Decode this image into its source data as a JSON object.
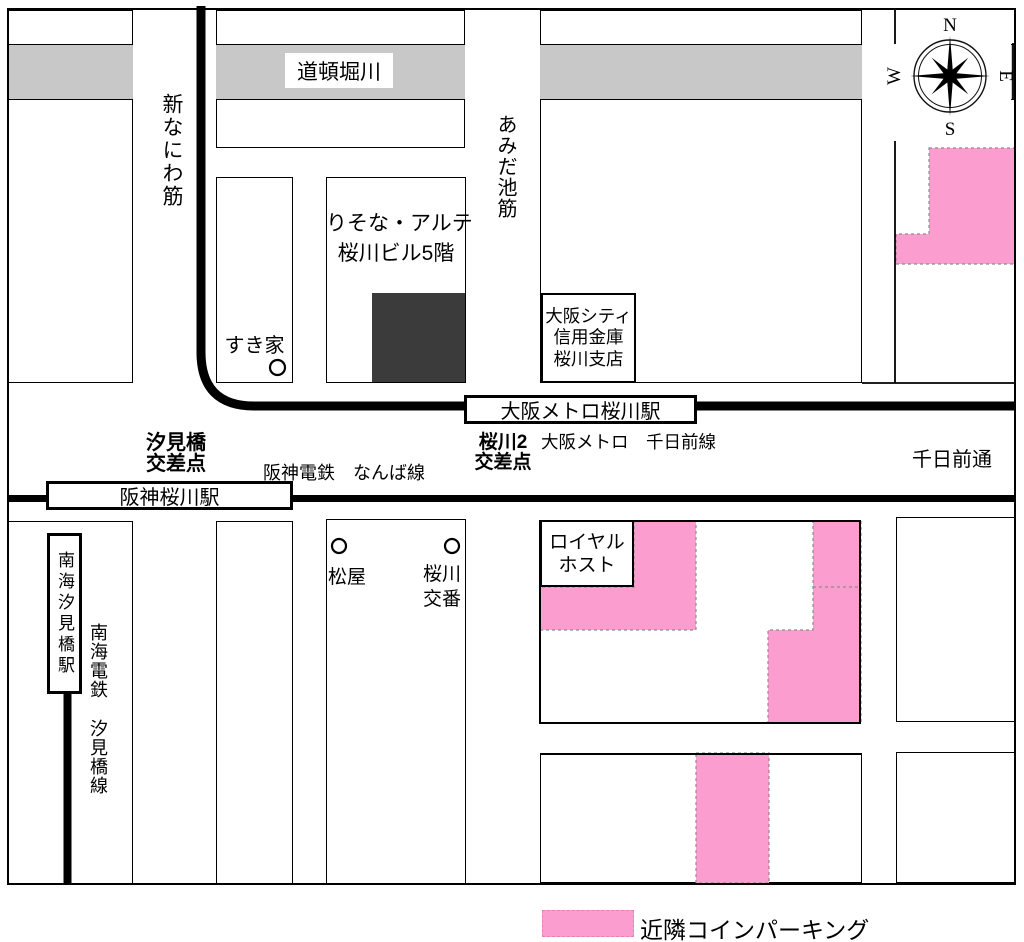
{
  "river": {
    "name": "道頓堀川"
  },
  "streets": {
    "shin_naniwa": "新なにわ筋",
    "amidaike": "あみだ池筋",
    "sennichimae": "千日前通"
  },
  "railways": {
    "metro": "大阪メトロ　千日前線",
    "hanshin": "阪神電鉄　なんば線",
    "nankai_company": "南海電鉄",
    "nankai_line": "汐見橋線"
  },
  "stations": {
    "metro": "大阪メトロ桜川駅",
    "hanshin": "阪神桜川駅",
    "nankai": "南海汐見橋駅"
  },
  "intersections": {
    "shiomibashi": [
      "汐見橋",
      "交差点"
    ],
    "sakuragawa2": [
      "桜川2",
      "交差点"
    ]
  },
  "destination": [
    "りそな・アルテ",
    "桜川ビル5階"
  ],
  "landmarks": {
    "sukiya": "すき家",
    "matsuya": "松屋",
    "koban": [
      "桜川",
      "交番"
    ],
    "bank": [
      "大阪シティ",
      "信用金庫",
      "桜川支店"
    ],
    "royal_host": [
      "ロイヤル",
      "ホスト"
    ]
  },
  "legend": {
    "parking": "近隣コインパーキング"
  },
  "compass": {
    "n": "N",
    "e": "E",
    "s": "S",
    "w": "W"
  },
  "colors": {
    "parking_pink": "#fb9dce",
    "river_gray": "#c8c8c8",
    "building": "#3b3b3b"
  }
}
